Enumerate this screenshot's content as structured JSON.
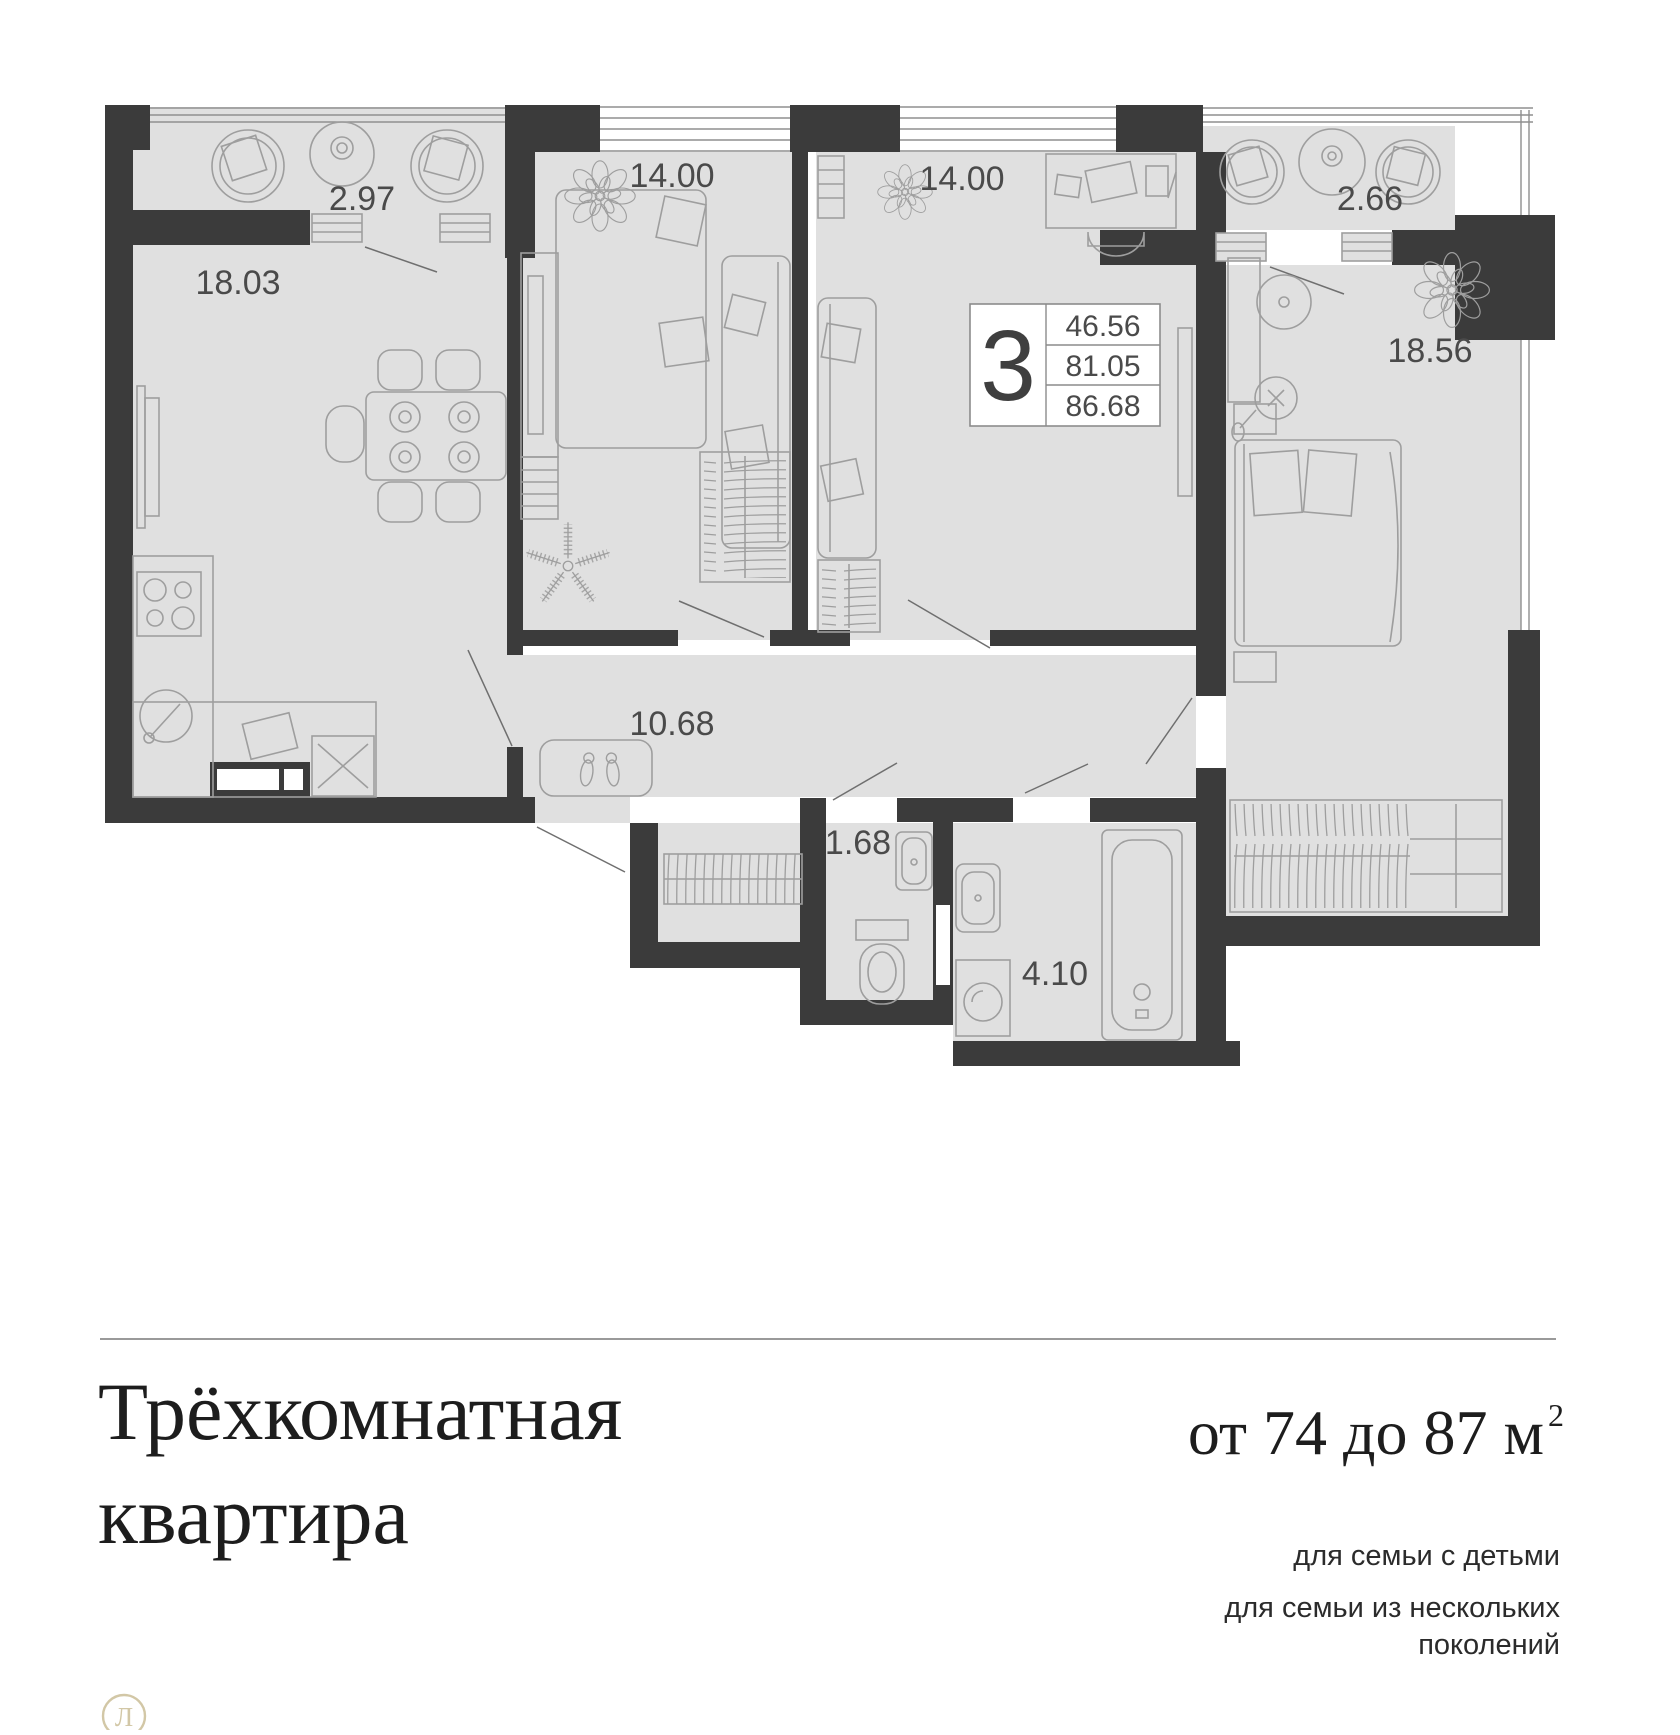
{
  "plan": {
    "labels": {
      "balcony_1": "2.97",
      "kitchen_living": "18.03",
      "bedroom_2": "14.00",
      "bedroom_3": "14.00",
      "balcony_2": "2.66",
      "master_bedroom": "18.56",
      "hallway": "10.68",
      "wc": "1.68",
      "bathroom": "4.10"
    },
    "info_box": {
      "rooms_count": "3",
      "living_area": "46.56",
      "area_without_balconies": "81.05",
      "total_area": "86.68"
    }
  },
  "footer": {
    "title_line_1": "Трёхкомнатная",
    "title_line_2": "квартира",
    "area_range": "от 74 до 87 м",
    "area_range_sup": "2",
    "tag_1": "для семьи с детьми",
    "tag_2": "для семьи из нескольких поколений"
  },
  "logo": {
    "letter": "Л"
  },
  "colors": {
    "wall": "#3b3b3b",
    "floor": "#e0e0e0",
    "furniture_stroke": "#9e9e9e",
    "label_text": "#4a4a4a",
    "logo_beige": "#d2c7a6"
  }
}
